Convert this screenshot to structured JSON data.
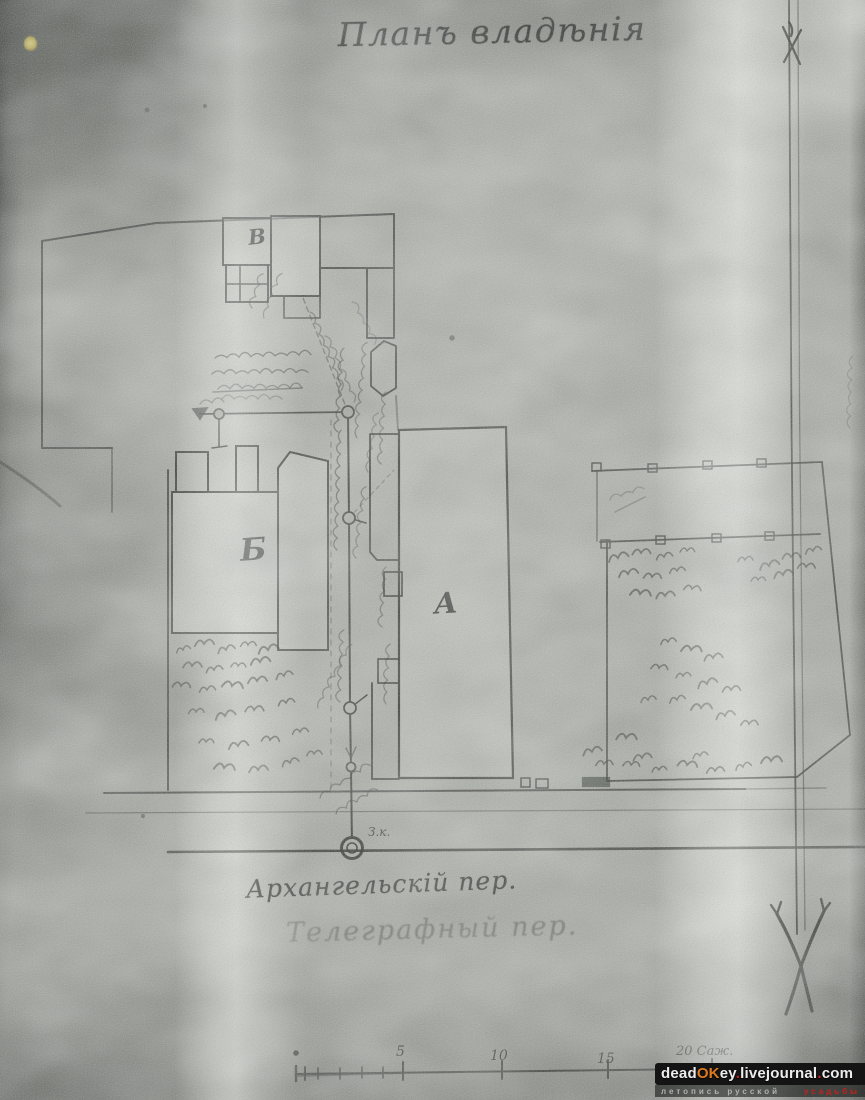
{
  "title": "Планъ владѣнія",
  "plan": {
    "buildings": [
      {
        "id": "top-wing",
        "label": "В"
      },
      {
        "id": "left-house",
        "label": "Б"
      },
      {
        "id": "main-house",
        "label": "А"
      }
    ],
    "well_label": "З.к.",
    "street_primary": "Архангельскій пер.",
    "street_secondary": "Телеграфный пер."
  },
  "scale_bar": {
    "tick_labels": [
      "5",
      "10",
      "15"
    ],
    "end_label": "20 Саж."
  },
  "watermark": {
    "site": [
      {
        "text": "dead",
        "color": "#ececec"
      },
      {
        "text": "OK",
        "color": "#e07a1e"
      },
      {
        "text": "ey",
        "color": "#ececec"
      },
      {
        "text": ".",
        "color": "#c9201c"
      },
      {
        "text": "livejournal",
        "color": "#ececec"
      },
      {
        "text": ".",
        "color": "#c9201c"
      },
      {
        "text": "com",
        "color": "#ececec"
      }
    ],
    "tagline": [
      {
        "text": "летопись русской",
        "color": "#adb3ad"
      },
      {
        "text": "усадьбы",
        "color": "#c9201c"
      }
    ]
  }
}
